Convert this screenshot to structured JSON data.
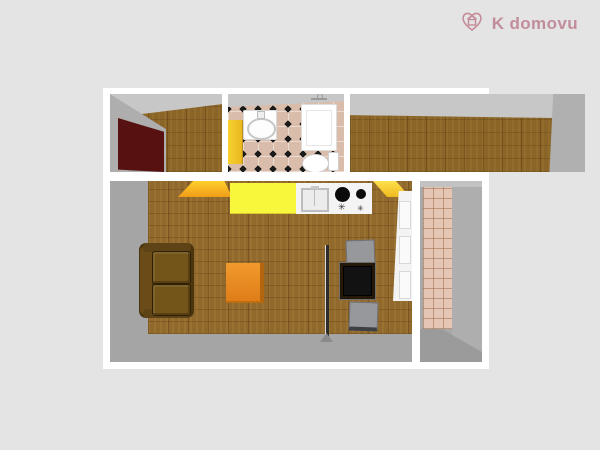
{
  "brand": {
    "logo_text": "K domovu",
    "logo_color": "#c28d9b",
    "logo_icon": "heart-house-icon"
  },
  "stove": {
    "knob_glyph": "✳"
  },
  "palette": {
    "background": "#e4e4e4",
    "wall_white": "#ffffff",
    "wall_face_gray": "#a8a8a8",
    "wood_floor": "#8b6527",
    "bathroom_tile": "#d9bca9",
    "tile_diamond": "#1a1a1a",
    "hallway_tile": "#e5c6b5",
    "kitchen_counter_yellow": "#f8f73b",
    "door_orange": "#f09c18",
    "door_yellow": "#efb91d",
    "wardrobe_maroon": "#571111",
    "sofa_brown": "#4a350f",
    "coffee_table_orange": "#e5821e",
    "chair_gray": "#97989c"
  },
  "floor_plan": {
    "type": "3d-top-down-apartment-render",
    "rooms": [
      {
        "name": "room-top-left",
        "floor": "wood",
        "items": [
          "wardrobe"
        ]
      },
      {
        "name": "bathroom",
        "floor": "checkered-tile",
        "items": [
          "door",
          "washbasin",
          "shower",
          "toilet"
        ]
      },
      {
        "name": "room-top-right",
        "floor": "wood",
        "items": []
      },
      {
        "name": "living-room-kitchen",
        "floor": "wood-parquet",
        "items": [
          "open-door",
          "kitchen-counter",
          "sink",
          "stove",
          "open-door",
          "sofa",
          "coffee-table",
          "partition",
          "dining-table",
          "chair",
          "chair",
          "white-door"
        ]
      },
      {
        "name": "hallway",
        "floor": "small-tile",
        "items": []
      }
    ]
  }
}
